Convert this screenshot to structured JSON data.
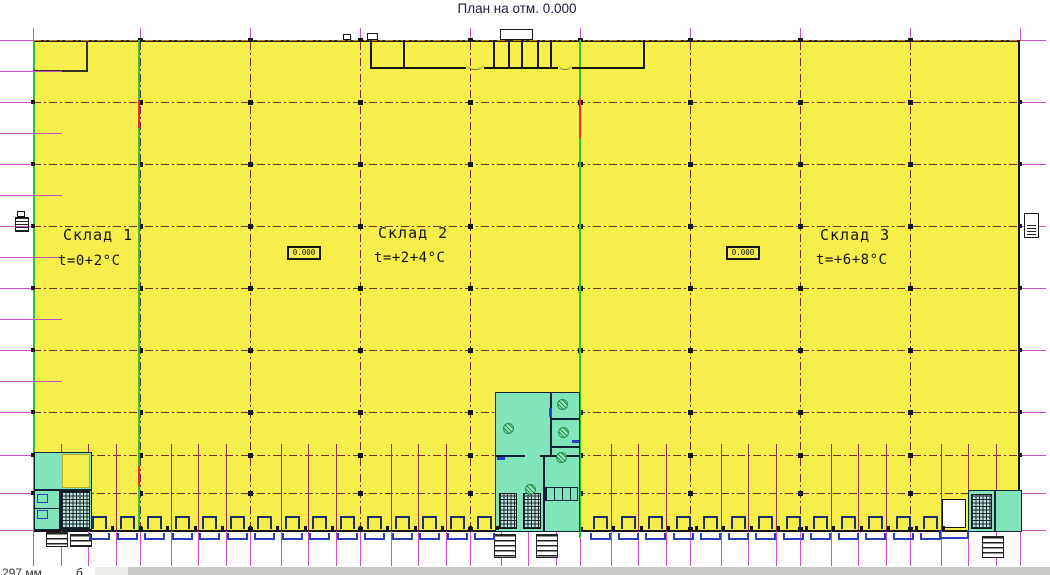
{
  "title": "План на отм. 0.000",
  "zones": [
    {
      "name": "Склад 1",
      "temp": "t=0+2°C"
    },
    {
      "name": "Склад 2",
      "temp": "t=+2+4°C"
    },
    {
      "name": "Склад 3",
      "temp": "t=+6+8°C"
    }
  ],
  "elevation_markers": [
    {
      "value": "0.000"
    },
    {
      "value": "0.000"
    }
  ],
  "footer": {
    "left_fragment": "297 мм",
    "right_fragment": "б"
  },
  "colors": {
    "floor_yellow": "#f6ee4b",
    "room_cyan": "#82e4ba",
    "grid_magenta": "#cb4fcb",
    "grid_dark": "#7c2836",
    "grid_dark_minor": "#93324a",
    "wall_black": "#161616",
    "wall_navy": "#112233",
    "firewall_green": "#2dc52d",
    "alarm_red": "#ee2a2a",
    "dock_navy": "#1d2e6e",
    "dock_blue": "#2a3ec0",
    "top_wall_orange": "#c87818",
    "fan_green": "#1e8f4e",
    "strip_light": "#ededea",
    "strip_dark": "#c9c9c6"
  }
}
